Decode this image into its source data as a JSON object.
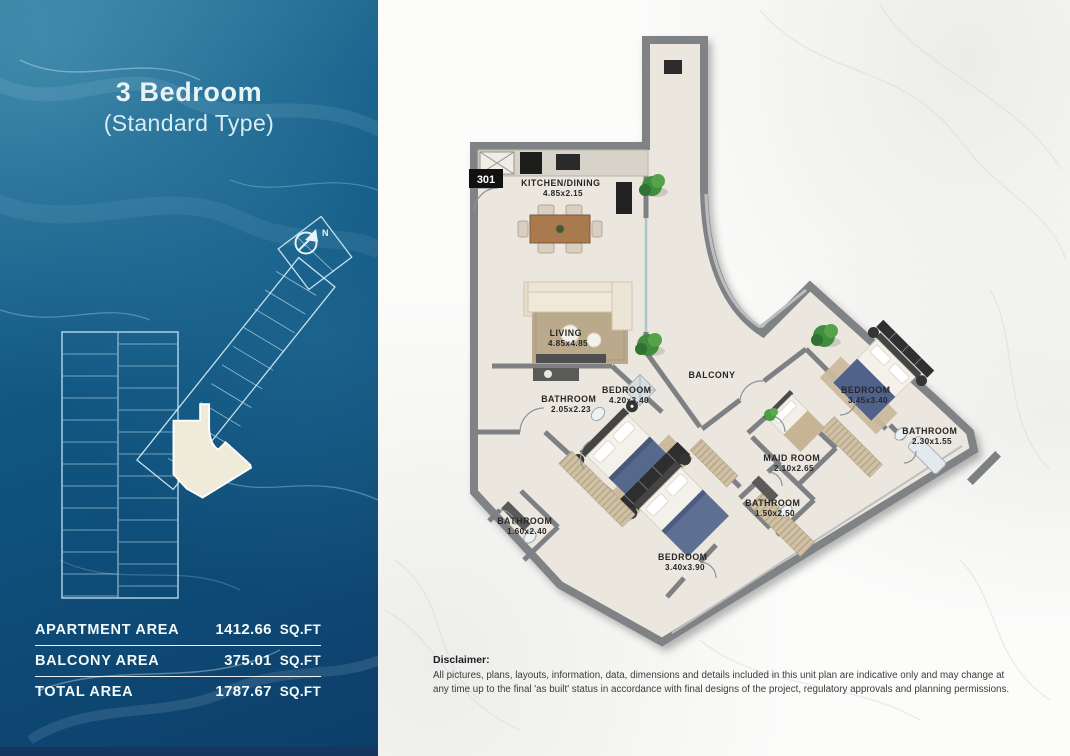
{
  "header": {
    "title": "3 Bedroom",
    "subtitle": "(Standard Type)"
  },
  "key_plan": {
    "north_label": "N"
  },
  "area_table": {
    "rows": [
      {
        "label": "APARTMENT AREA",
        "value": "1412.66",
        "unit": "SQ.FT"
      },
      {
        "label": "BALCONY AREA",
        "value": "375.01",
        "unit": "SQ.FT"
      },
      {
        "label": "TOTAL AREA",
        "value": "1787.67",
        "unit": "SQ.FT"
      }
    ]
  },
  "floor_plan": {
    "unit_number": "301",
    "rooms": [
      {
        "name": "KITCHEN/DINING",
        "dims": "4.85x2.15"
      },
      {
        "name": "LIVING",
        "dims": "4.85x4.85"
      },
      {
        "name": "BALCONY",
        "dims": ""
      },
      {
        "name": "BATHROOM",
        "dims": "2.05x2.23"
      },
      {
        "name": "BEDROOM",
        "dims": "4.20x3.40"
      },
      {
        "name": "MAID ROOM",
        "dims": "2.10x2.65"
      },
      {
        "name": "BATHROOM",
        "dims": "1.50x2.50"
      },
      {
        "name": "BEDROOM",
        "dims": "3.45x3.40"
      },
      {
        "name": "BATHROOM",
        "dims": "2.30x1.55"
      },
      {
        "name": "BATHROOM",
        "dims": "1.60x2.40"
      },
      {
        "name": "BEDROOM",
        "dims": "3.40x3.90"
      }
    ]
  },
  "disclaimer": {
    "title": "Disclaimer:",
    "body": "All pictures, plans, layouts, information, data, dimensions and details included in this unit plan are indicative only and may change at any time up to the final 'as built' status in accordance with final designs of the project, regulatory approvals and planning permissions."
  },
  "colors": {
    "ocean_blue": "#125a86",
    "floor_beige": "#ebe7df",
    "wall_gray": "#7e8184",
    "accent_green": "#4e9b45",
    "bed_blue": "#56688c",
    "text_light": "#f2fafc"
  }
}
